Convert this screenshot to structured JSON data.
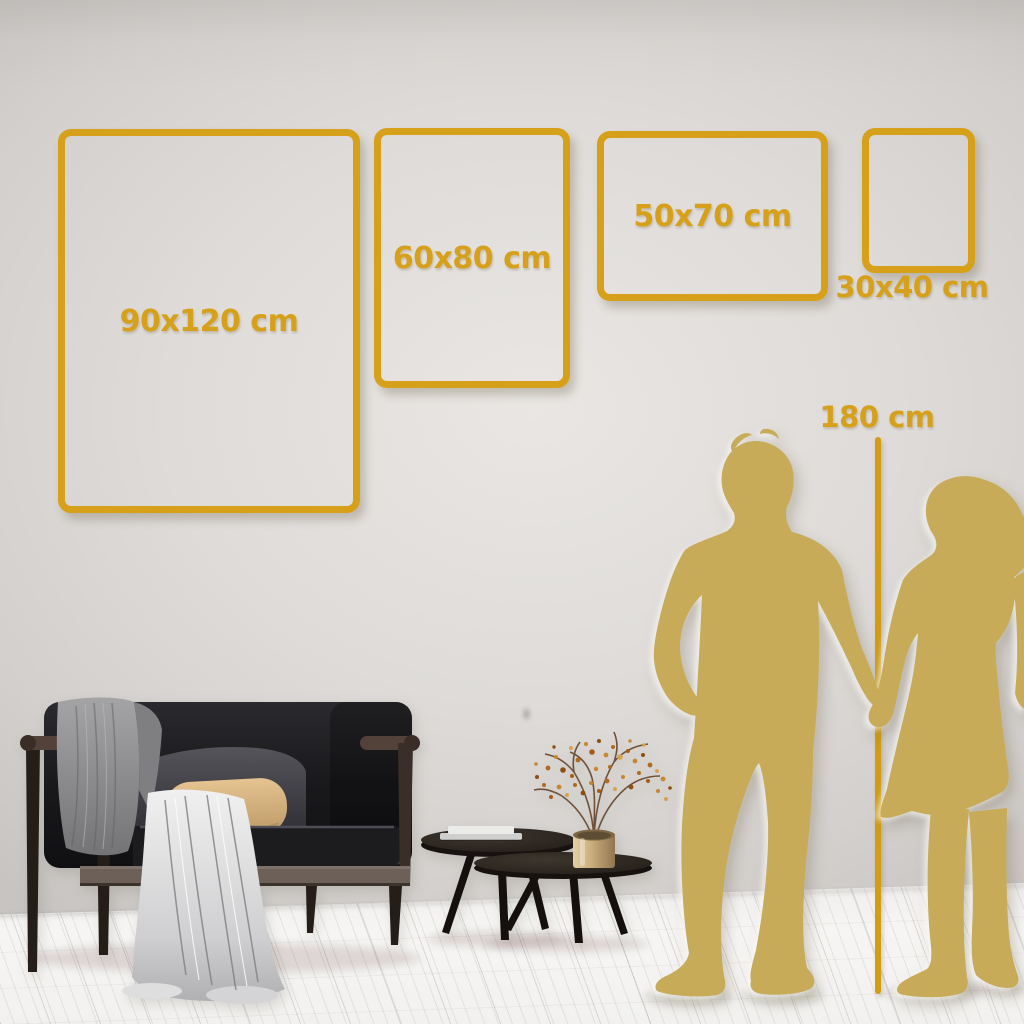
{
  "size_guide": {
    "frames": [
      {
        "size_label": "90x120 cm",
        "width_cm": 90,
        "height_cm": 120
      },
      {
        "size_label": "60x80 cm",
        "width_cm": 60,
        "height_cm": 80
      },
      {
        "size_label": "50x70 cm",
        "width_cm": 50,
        "height_cm": 70
      },
      {
        "size_label": "30x40 cm",
        "width_cm": 30,
        "height_cm": 40
      }
    ],
    "height_reference": {
      "label": "180 cm",
      "value_cm": 180
    }
  },
  "colors": {
    "frame_gold": "#D7A01B",
    "ruler_gold": "#D29D12",
    "silhouette_gold": "#C7AB58",
    "wall_gray": "#DAD7D4",
    "floor_white": "#F5F4F2"
  },
  "scene": {
    "illustration_items": [
      "couple-silhouette",
      "height-ruler-line",
      "sofa",
      "throw-blankets",
      "cushions",
      "nesting-coffee-tables",
      "books",
      "gold-vase",
      "dried-branch-plant",
      "wood-plank-floor"
    ]
  }
}
